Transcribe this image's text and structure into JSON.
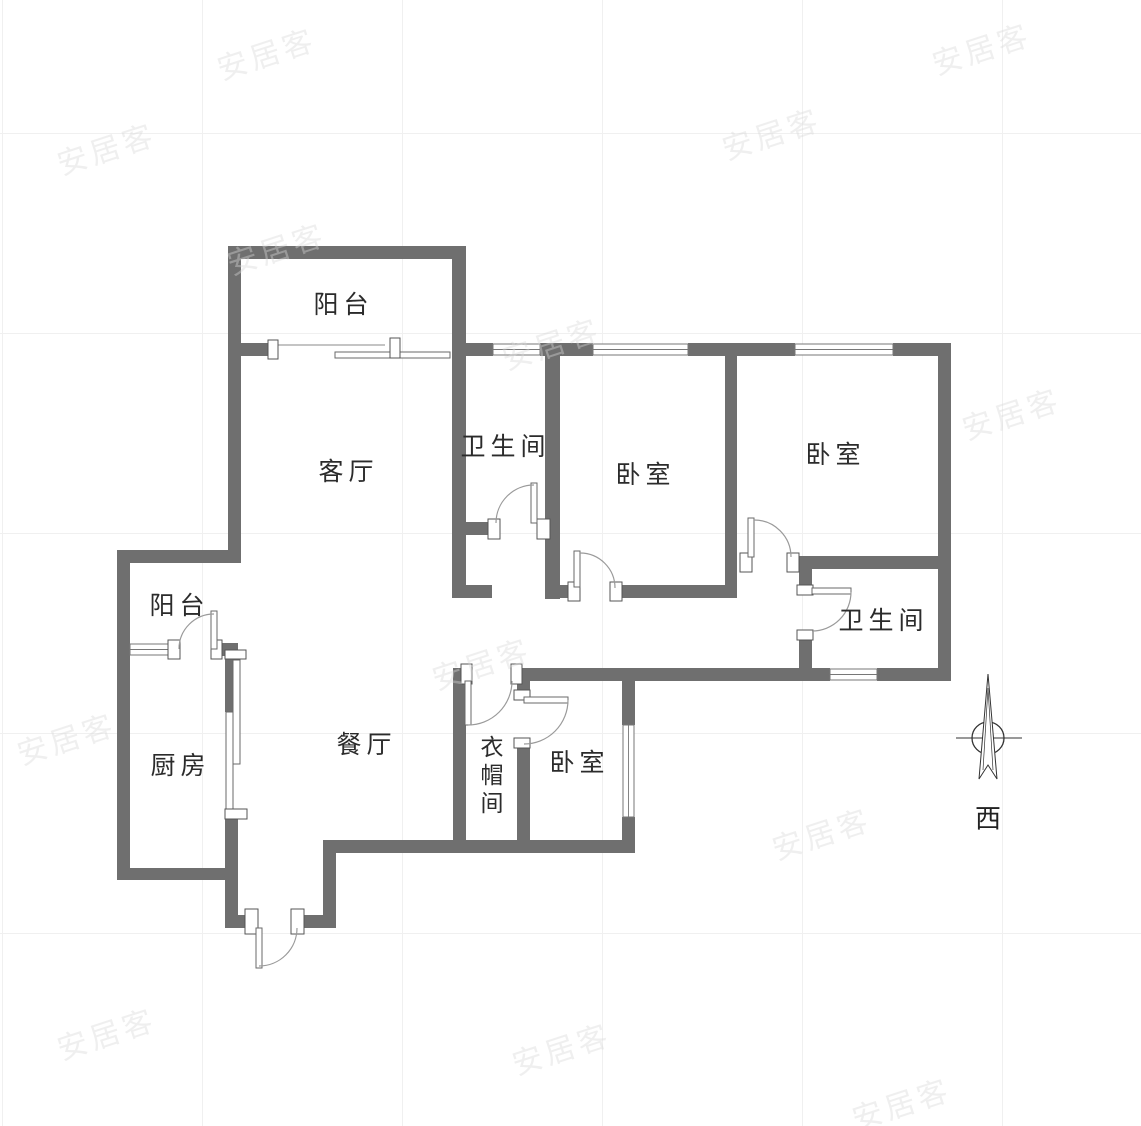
{
  "watermark": {
    "text": "安居客"
  },
  "compass": {
    "direction_label": "西"
  },
  "rooms": [
    {
      "id": "balcony-north",
      "label": "阳台"
    },
    {
      "id": "living-room",
      "label": "客厅"
    },
    {
      "id": "bathroom-1",
      "label": "卫生间"
    },
    {
      "id": "bedroom-1",
      "label": "卧室"
    },
    {
      "id": "bedroom-2",
      "label": "卧室"
    },
    {
      "id": "bathroom-2",
      "label": "卫生间"
    },
    {
      "id": "balcony-west",
      "label": "阳台"
    },
    {
      "id": "kitchen",
      "label": "厨房"
    },
    {
      "id": "dining-room",
      "label": "餐厅"
    },
    {
      "id": "closet",
      "label": "衣帽间"
    },
    {
      "id": "bedroom-3",
      "label": "卧室"
    }
  ],
  "colors": {
    "wall": "#6f6f6f",
    "door_arc": "#9a9a9a",
    "label_text": "#2b2b2b",
    "grid_line": "#f0f0f0",
    "background": "#ffffff"
  }
}
